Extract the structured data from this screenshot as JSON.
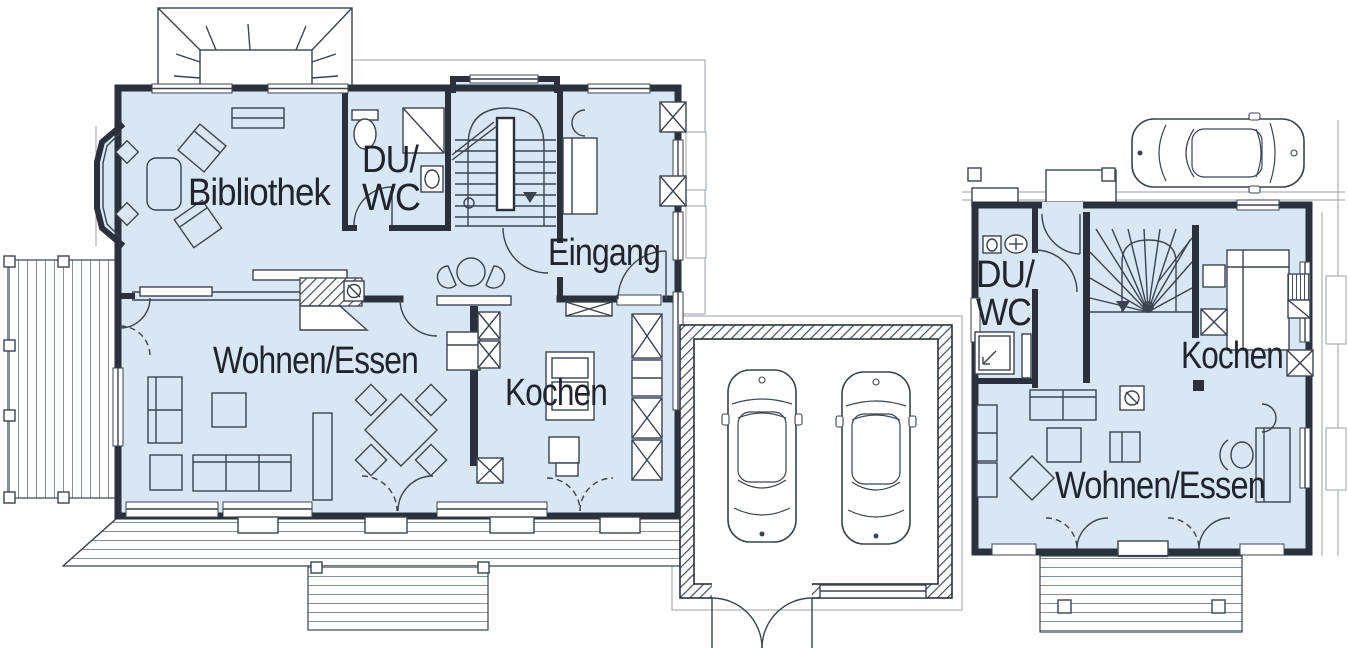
{
  "drawing": {
    "kind": "floor-plan",
    "colors": {
      "room_fill": "#d8e7f3",
      "wall": "#2a313c",
      "line": "#3a434f",
      "site_line": "#9aa2ab",
      "deck_line": "#848d98",
      "text": "#20242c"
    }
  },
  "main_house": {
    "labels": {
      "bibliothek": "Bibliothek",
      "du": "DU/",
      "wc": "WC",
      "eingang": "Eingang",
      "wohnen_essen": "Wohnen/Essen",
      "kochen": "Kochen"
    }
  },
  "small_house": {
    "labels": {
      "du": "DU/",
      "wc": "WC",
      "kochen": "Kochen",
      "wohnen_essen": "Wohnen/Essen"
    }
  }
}
